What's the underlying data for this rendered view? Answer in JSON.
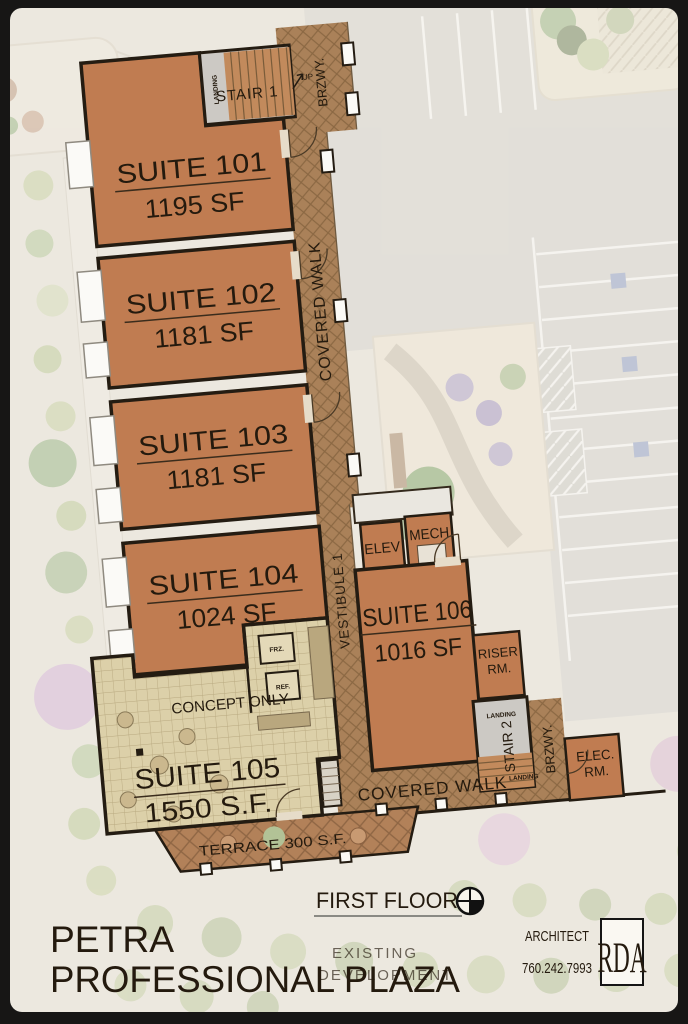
{
  "sheet": {
    "floor_label": "FIRST FLOOR",
    "title_line1": "PETRA",
    "title_line2": "PROFESSIONAL PLAZA",
    "background_note_line1": "EXISTING",
    "background_note_line2": "DEVELOPMENT"
  },
  "architect": {
    "label": "ARCHITECT",
    "phone": "760.242.7993",
    "logo_text": "RDA"
  },
  "suites": [
    {
      "name": "SUITE 101",
      "area": "1195 SF"
    },
    {
      "name": "SUITE 102",
      "area": "1181 SF"
    },
    {
      "name": "SUITE 103",
      "area": "1181 SF"
    },
    {
      "name": "SUITE 104",
      "area": "1024 SF"
    },
    {
      "name": "SUITE 105",
      "area": "1550 S.F."
    },
    {
      "name": "SUITE 106",
      "area": "1016 SF"
    }
  ],
  "circulation": {
    "stair1": "STAIR 1",
    "stair1_up": "UP",
    "stair1_landing": "LANDING",
    "breezeway_top": "BRZWY.",
    "covered_walk_side": "COVERED WALK",
    "vestibule": "VESTIBULE 1",
    "covered_walk_bottom": "COVERED WALK",
    "stair2": "STAIR 2",
    "stair2_landing": "LANDING",
    "walk_landing": "LANDING",
    "breezeway_bottom": "BRZWY."
  },
  "rooms": {
    "elev": "ELEV",
    "mech": "MECH",
    "riser_line1": "RISER",
    "riser_line2": "RM.",
    "elec_line1": "ELEC.",
    "elec_line2": "RM.",
    "freezer": "FRZ.",
    "refrigerator": "REF.",
    "concept_note": "CONCEPT ONLY",
    "terrace": "TERRACE 300 S.F."
  },
  "colors": {
    "suite_fill": "#c07c51",
    "walkway": "#aa8159",
    "terrace": "#b28159",
    "tile_floor": "#dcd0a9",
    "wall_ink": "#241c12",
    "paper": "#ece8df",
    "frame": "#171615"
  }
}
